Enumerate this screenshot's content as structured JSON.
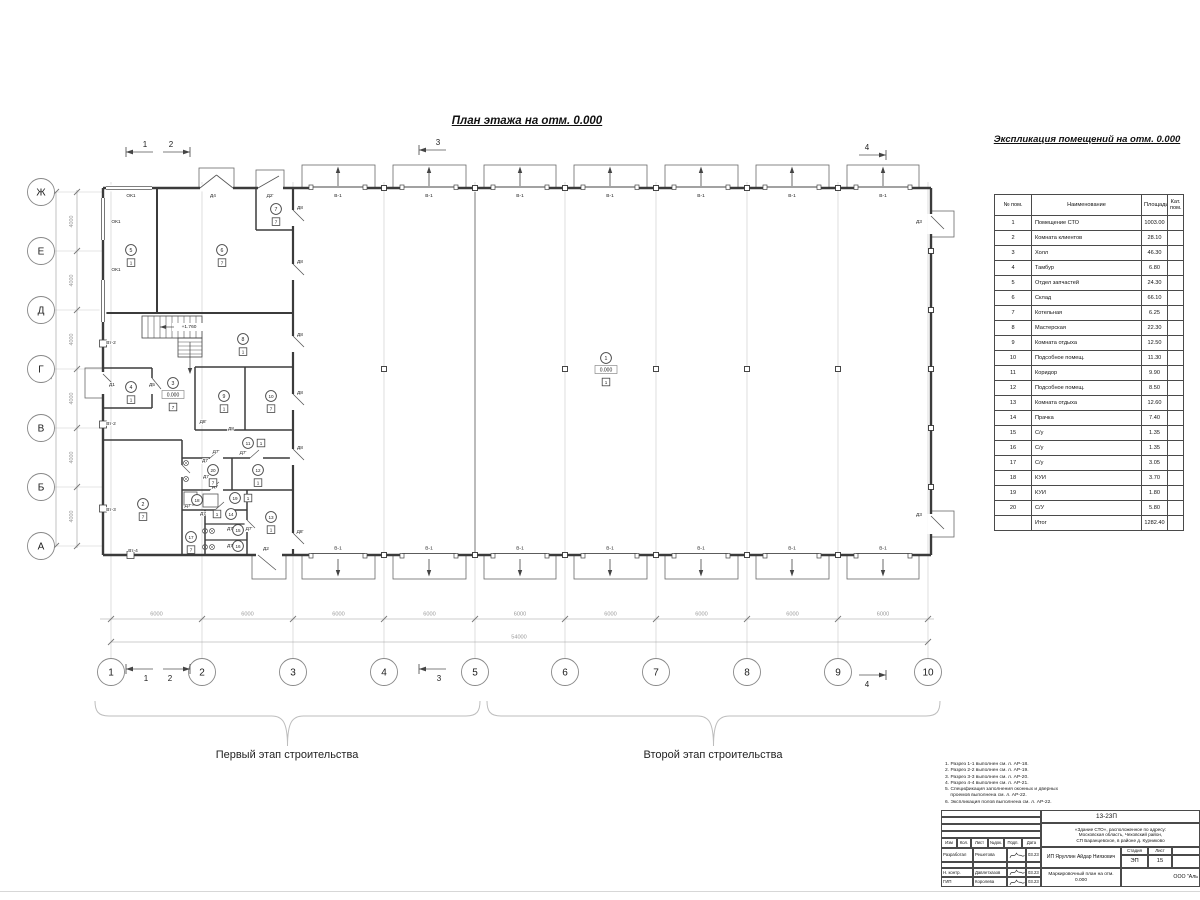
{
  "page": {
    "plan_title": "План этажа на отм. 0.000",
    "schedule_title": "Экспликация помещений на отм. 0.000",
    "stage1_label": "Первый этап строительства",
    "stage2_label": "Второй этап строительства"
  },
  "schedule": {
    "headers": [
      "№ пом.",
      "Наименование",
      "Площадь",
      "Кат. пом."
    ],
    "rows": [
      [
        "1",
        "Помещение СТО",
        "1003.00",
        ""
      ],
      [
        "2",
        "Комната клиентов",
        "28.10",
        ""
      ],
      [
        "3",
        "Холл",
        "46.30",
        ""
      ],
      [
        "4",
        "Тамбур",
        "6.80",
        ""
      ],
      [
        "5",
        "Отдел запчастей",
        "24.30",
        ""
      ],
      [
        "6",
        "Склад",
        "66.10",
        ""
      ],
      [
        "7",
        "Котельная",
        "6.25",
        ""
      ],
      [
        "8",
        "Мастерская",
        "22.30",
        ""
      ],
      [
        "9",
        "Комната отдыха",
        "12.50",
        ""
      ],
      [
        "10",
        "Подсобное помещ.",
        "11.30",
        ""
      ],
      [
        "11",
        "Коридор",
        "9.90",
        ""
      ],
      [
        "12",
        "Подсобное помещ.",
        "8.50",
        ""
      ],
      [
        "13",
        "Комната отдыха",
        "12.60",
        ""
      ],
      [
        "14",
        "Прачка",
        "7.40",
        ""
      ],
      [
        "15",
        "С/у",
        "1.35",
        ""
      ],
      [
        "16",
        "С/у",
        "1.35",
        ""
      ],
      [
        "17",
        "С/у",
        "3.05",
        ""
      ],
      [
        "18",
        "КУИ",
        "3.70",
        ""
      ],
      [
        "19",
        "КУИ",
        "1.80",
        ""
      ],
      [
        "20",
        "С/У",
        "5.80",
        ""
      ]
    ],
    "total_label": "Итог",
    "total_value": "1282.40"
  },
  "notes": [
    "1. Разрез 1-1 выполнен см. л. АР-18.",
    "2. Разрез 2-2 выполнен см. л. АР-19.",
    "3. Разрез 3-3 выполнен см. л. АР-20.",
    "4. Разрез 4-4 выполнен см. л. АР-21.",
    "5. Спецификация заполнения оконных и дверных",
    "    проемов выполнена см. л. АР-22.",
    "6. Экспликация полов выполнена см. л. АР-22."
  ],
  "title_block": {
    "doc_number": "13-23П",
    "address_lines": [
      "«Здание СТО», расположенное по адресу:",
      "Московская область, Чеховский район,",
      "СП Баранцевское, в районе д. Курниково"
    ],
    "columns": [
      "Изм",
      "Кол.",
      "Лист",
      "№док.",
      "Подп.",
      "Дата"
    ],
    "rows": [
      {
        "role": "Разработал",
        "name": "Решетова",
        "date": "03.23"
      },
      {
        "role": "Н. контр.",
        "name": "Давлетхазов",
        "date": "03.23"
      },
      {
        "role": "ГИП",
        "name": "Королева",
        "date": "03.23"
      }
    ],
    "client": "ИП Яруллин Айдар Ниязович",
    "stage_label": "Стадия",
    "sheet_label": "Лист",
    "stage_value": "ЭП",
    "sheet_value": "15",
    "sheet_title": "Маркировочный план на отм. 0.000",
    "company": "ООО \"Аль"
  },
  "plan": {
    "axes_bottom": [
      {
        "label": "1",
        "x": 111
      },
      {
        "label": "2",
        "x": 202
      },
      {
        "label": "3",
        "x": 293
      },
      {
        "label": "4",
        "x": 384
      },
      {
        "label": "5",
        "x": 475
      },
      {
        "label": "6",
        "x": 565
      },
      {
        "label": "7",
        "x": 656
      },
      {
        "label": "8",
        "x": 747
      },
      {
        "label": "9",
        "x": 838
      },
      {
        "label": "10",
        "x": 928
      }
    ],
    "axes_left": [
      {
        "label": "Ж",
        "y": 192
      },
      {
        "label": "Е",
        "y": 251
      },
      {
        "label": "Д",
        "y": 310
      },
      {
        "label": "Г",
        "y": 369
      },
      {
        "label": "В",
        "y": 428
      },
      {
        "label": "Б",
        "y": 487
      },
      {
        "label": "А",
        "y": 546
      }
    ],
    "dim_bay": "6000",
    "dim_total_bottom": "54000",
    "dim_bay_left": "4000",
    "dim_total_left": "24000",
    "gate_label": "В-1",
    "gates_top_x": [
      338,
      429,
      520,
      610,
      701,
      792,
      883
    ],
    "gates_bottom_x": [
      338,
      429,
      520,
      610,
      701,
      792,
      883
    ],
    "section_markers": [
      {
        "label": "1",
        "x": 140,
        "y": 152,
        "dir": "left",
        "lx": 145,
        "ly": 147
      },
      {
        "label": "2",
        "x": 176,
        "y": 152,
        "dir": "right",
        "lx": 171,
        "ly": 147
      },
      {
        "label": "3",
        "x": 433,
        "y": 150,
        "dir": "left",
        "lx": 438,
        "ly": 145
      },
      {
        "label": "4",
        "x": 872,
        "y": 155,
        "dir": "right",
        "lx": 867,
        "ly": 150
      },
      {
        "label": "1",
        "x": 140,
        "y": 669,
        "dir": "left",
        "lx": 146,
        "ly": 681
      },
      {
        "label": "2",
        "x": 176,
        "y": 669,
        "dir": "right",
        "lx": 170,
        "ly": 681
      },
      {
        "label": "3",
        "x": 433,
        "y": 669,
        "dir": "left",
        "lx": 439,
        "ly": 681
      },
      {
        "label": "4",
        "x": 872,
        "y": 675,
        "dir": "right",
        "lx": 867,
        "ly": 687
      }
    ],
    "room_markers": [
      {
        "n": "1",
        "x": 606,
        "y": 358,
        "floor": "1",
        "elev": "0.000"
      },
      {
        "n": "2",
        "x": 143,
        "y": 504,
        "floor": "7"
      },
      {
        "n": "3",
        "x": 173,
        "y": 383,
        "floor": "7",
        "elev": "0.000"
      },
      {
        "n": "4",
        "x": 131,
        "y": 387,
        "floor": "1"
      },
      {
        "n": "5",
        "x": 131,
        "y": 250,
        "floor": "1"
      },
      {
        "n": "6",
        "x": 222,
        "y": 250,
        "floor": "7"
      },
      {
        "n": "7",
        "x": 276,
        "y": 209,
        "floor": "7"
      },
      {
        "n": "8",
        "x": 243,
        "y": 339,
        "floor": "1"
      },
      {
        "n": "9",
        "x": 224,
        "y": 396,
        "floor": "1"
      },
      {
        "n": "10",
        "x": 271,
        "y": 396,
        "floor": "7"
      },
      {
        "n": "11",
        "x": 248,
        "y": 443,
        "floor": "1",
        "side": "right"
      },
      {
        "n": "12",
        "x": 258,
        "y": 470,
        "floor": "1"
      },
      {
        "n": "13",
        "x": 271,
        "y": 517,
        "floor": "1"
      },
      {
        "n": "14",
        "x": 231,
        "y": 514,
        "floor": "1",
        "side": "left"
      },
      {
        "n": "15",
        "x": 238,
        "y": 530
      },
      {
        "n": "16",
        "x": 238,
        "y": 546
      },
      {
        "n": "17",
        "x": 191,
        "y": 537,
        "floor": "7"
      },
      {
        "n": "18",
        "x": 197,
        "y": 500
      },
      {
        "n": "19",
        "x": 235,
        "y": 498,
        "floor": "1",
        "side": "right"
      },
      {
        "n": "20",
        "x": 213,
        "y": 470,
        "floor": "7"
      }
    ],
    "labels": [
      {
        "t": "ОК1",
        "x": 131,
        "y": 197
      },
      {
        "t": "ОК1",
        "x": 116,
        "y": 223
      },
      {
        "t": "ОК1",
        "x": 116,
        "y": 271
      },
      {
        "t": "Д4",
        "x": 213,
        "y": 197
      },
      {
        "t": "Д2'",
        "x": 270,
        "y": 197
      },
      {
        "t": "Д8",
        "x": 300,
        "y": 209
      },
      {
        "t": "Д8",
        "x": 300,
        "y": 263
      },
      {
        "t": "Д8",
        "x": 300,
        "y": 336
      },
      {
        "t": "Д8",
        "x": 300,
        "y": 394
      },
      {
        "t": "Д8",
        "x": 300,
        "y": 449
      },
      {
        "t": "Д8'",
        "x": 300,
        "y": 533
      },
      {
        "t": "Д5",
        "x": 152,
        "y": 386
      },
      {
        "t": "Д1",
        "x": 112,
        "y": 386
      },
      {
        "t": "Д8'",
        "x": 203,
        "y": 423
      },
      {
        "t": "Д8",
        "x": 231,
        "y": 430
      },
      {
        "t": "Д3",
        "x": 919,
        "y": 223
      },
      {
        "t": "Д3",
        "x": 919,
        "y": 516
      },
      {
        "t": "Д2",
        "x": 266,
        "y": 550
      },
      {
        "t": "Вт-2",
        "x": 111,
        "y": 344
      },
      {
        "t": "Вт-2",
        "x": 111,
        "y": 425
      },
      {
        "t": "Вт-3",
        "x": 111,
        "y": 511
      },
      {
        "t": "Вт-4",
        "x": 133,
        "y": 552
      },
      {
        "t": "Д7'",
        "x": 216,
        "y": 453
      },
      {
        "t": "Д7'",
        "x": 243,
        "y": 454
      },
      {
        "t": "Д7",
        "x": 205,
        "y": 462
      },
      {
        "t": "Д7",
        "x": 206,
        "y": 478
      },
      {
        "t": "Д7",
        "x": 215,
        "y": 488
      },
      {
        "t": "Д7'",
        "x": 188,
        "y": 507
      },
      {
        "t": "Д7",
        "x": 203,
        "y": 515
      },
      {
        "t": "Д7",
        "x": 230,
        "y": 530
      },
      {
        "t": "Д7'",
        "x": 249,
        "y": 530
      },
      {
        "t": "Д7",
        "x": 230,
        "y": 547
      },
      {
        "t": "+1.760",
        "x": 189,
        "y": 328
      }
    ]
  }
}
